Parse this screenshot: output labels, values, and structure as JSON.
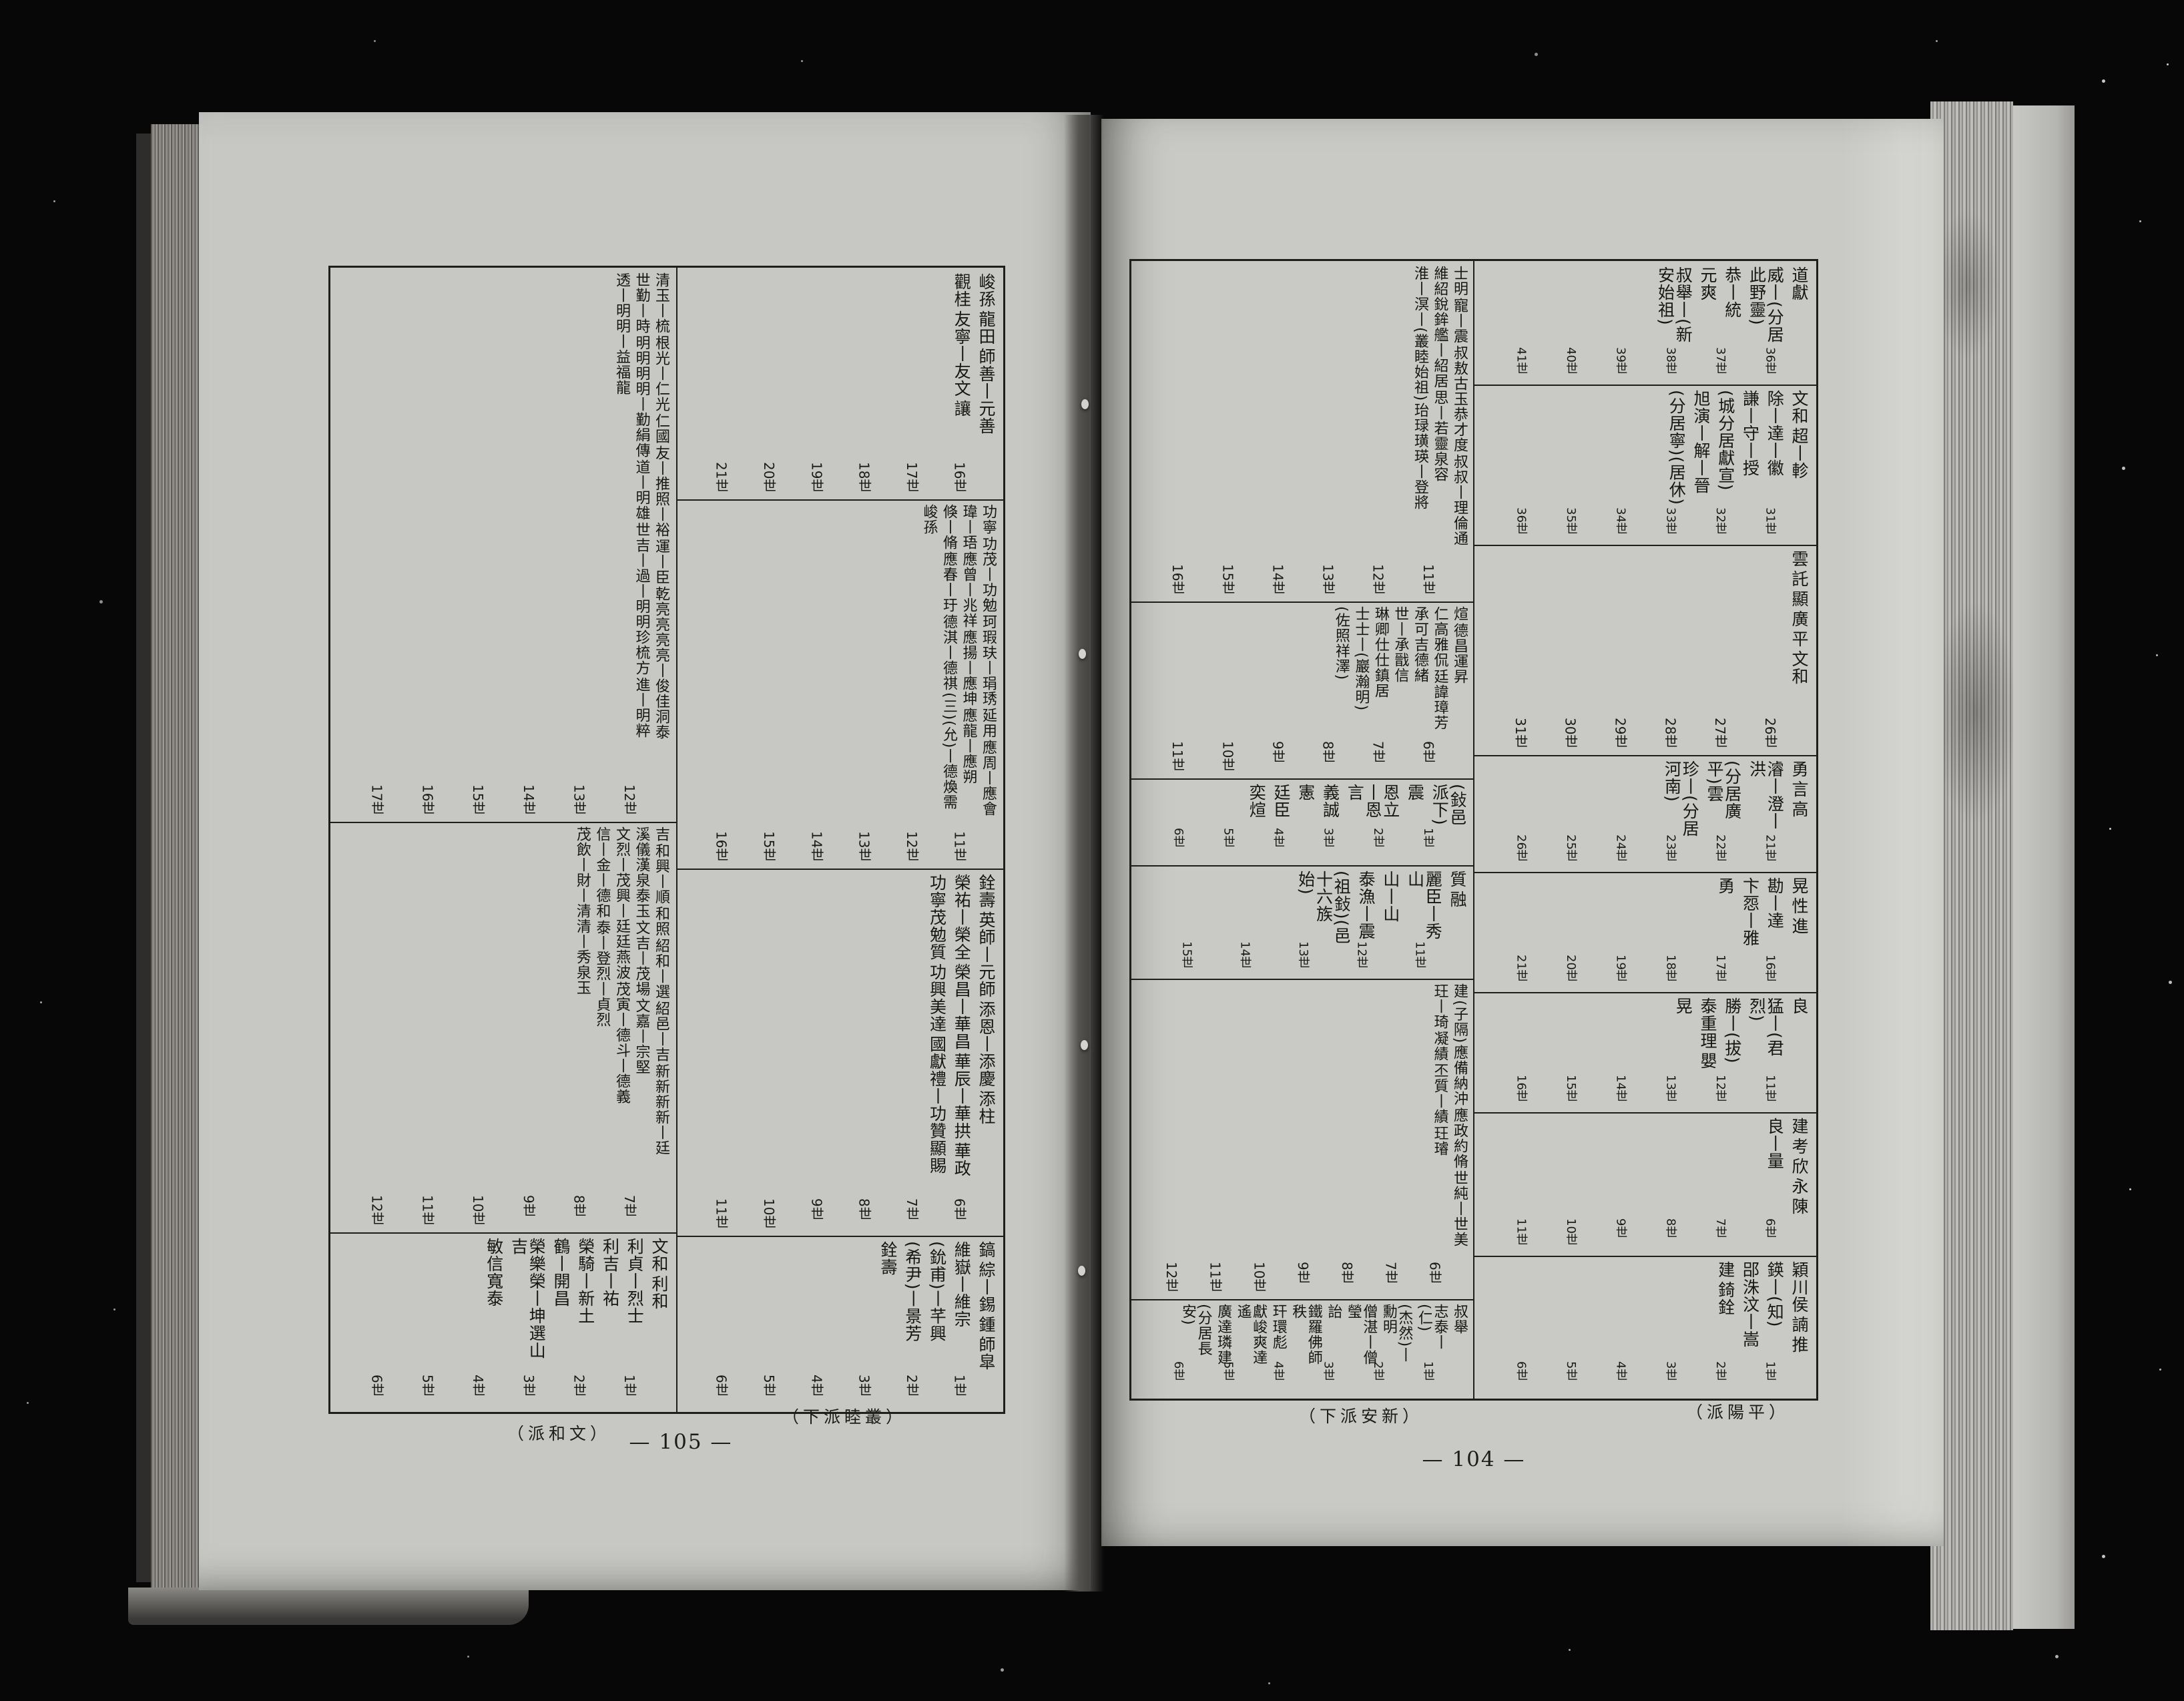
{
  "book": {
    "pages": {
      "left": {
        "page_number": "— 105 —",
        "margin_note_left": "（派和文）",
        "margin_note_right": "（下派睦叢）",
        "sections": {
          "a": {
            "generations": [
              "16世",
              "17世",
              "18世",
              "19世",
              "20世",
              "21世"
            ],
            "names": [
              "峻孫",
              "龍田",
              "師善丨元善",
              "觀桂",
              "友寧丨友文",
              "讓"
            ]
          },
          "b": {
            "generations": [
              "12世",
              "13世",
              "14世",
              "15世",
              "16世",
              "17世"
            ],
            "names": [
              "清玉丨梳",
              "根光丨仁光",
              "仁國",
              "友丨推照丨裕",
              "運丨臣",
              "乾亮亮亮亮丨俊佳洞泰",
              "世勤丨時",
              "明明明明丨勤絹傳",
              "道丨明雄",
              "世吉丨過丨明明珍梳方",
              "進丨明粹",
              "透丨明明丨益福龍"
            ]
          },
          "c": {
            "generations": [
              "11世",
              "12世",
              "13世",
              "14世",
              "15世",
              "16世"
            ],
            "names": [
              "功寧",
              "功茂丨功勉",
              "珂瑕玞丨琄琇",
              "延用",
              "應周丨應會",
              "瑋丨珸",
              "應曾丨兆祥",
              "應揚丨應坤",
              "應龍丨應朔",
              "倏丨脩",
              "應春丨玗",
              "德淇丨德祺",
              "(三)(允)丨德煥需",
              "峻孫"
            ]
          },
          "d": {
            "generations": [
              "6世",
              "7世",
              "8世",
              "9世",
              "10世",
              "11世"
            ],
            "names": [
              "銓壽",
              "英師丨元師",
              "添恩丨添慶",
              "添柱",
              "榮祐丨榮全",
              "榮昌丨華昌",
              "華辰丨華拱",
              "華政",
              "功寧茂勉質",
              "功興美達",
              "國獻禮丨功贊顯賜"
            ]
          },
          "e": {
            "generations": [
              "1世",
              "2世",
              "3世",
              "4世",
              "5世",
              "6世"
            ],
            "names": [
              "鎬",
              "綜丨錫",
              "鍾",
              "師皐",
              "維嶽丨維宗",
              "(鈗甫)丨芊興",
              "(希尹)丨景芳",
              "銓壽"
            ]
          },
          "f": {
            "generations": [
              "7世",
              "8世",
              "9世",
              "10世",
              "11世",
              "12世"
            ],
            "names": [
              "吉",
              "和興丨順",
              "和照",
              "紹和丨選",
              "紹邑丨吉",
              "新新新新丨廷",
              "溪儀漢泉泰玉",
              "文吉丨茂場",
              "文嘉丨宗堅",
              "文烈丨茂興丨廷廷燕波",
              "茂寅丨德斗丨德義",
              "信丨金丨德和",
              "泰丨登烈丨貞烈",
              "茂飲丨財丨清清丨秀泉玉"
            ]
          },
          "g": {
            "generations": [
              "1世",
              "2世",
              "3世",
              "4世",
              "5世",
              "6世"
            ],
            "names": [
              "文和",
              "利和",
              "利貞丨烈士",
              "利吉丨祐",
              "榮騎丨新土",
              "鶴丨開昌",
              "榮樂榮丨坤選山吉",
              "敏信寬泰"
            ]
          }
        }
      },
      "right": {
        "page_number": "— 104 —",
        "margin_note_left": "（下派安新）",
        "margin_note_right": "（派陽平）",
        "sections": {
          "a": {
            "generations": [
              "36世",
              "37世",
              "38世",
              "39世",
              "40世",
              "41世"
            ],
            "names": [
              "道獻",
              "威丨(分居此野靈)",
              "恭丨統",
              "元爽",
              "叔舉丨(新安始祖)"
            ]
          },
          "b": {
            "generations": [
              "31世",
              "32世",
              "33世",
              "34世",
              "35世",
              "36世"
            ],
            "names": [
              "文和",
              "超丨軫",
              "除丨達丨徽",
              "謙丨守丨授",
              "(城分居獻宣)",
              "旭演丨解丨晉",
              "(分居寧)(居休)"
            ]
          },
          "c": {
            "generations": [
              "26世",
              "27世",
              "28世",
              "29世",
              "30世",
              "31世"
            ],
            "names": [
              "雲",
              "託",
              "顯",
              "廣",
              "平",
              "文和"
            ]
          },
          "d": {
            "generations": [
              "21世",
              "22世",
              "23世",
              "24世",
              "25世",
              "26世"
            ],
            "names": [
              "勇",
              "言",
              "高",
              "濬丨澄丨洪",
              "(分居廣平)雲",
              "珍丨(分居河南)"
            ]
          },
          "e": {
            "generations": [
              "16世",
              "17世",
              "18世",
              "19世",
              "20世",
              "21世"
            ],
            "names": [
              "晃",
              "性",
              "進",
              "勘丨達",
              "卞㤪丨雅",
              "勇"
            ]
          },
          "f": {
            "generations": [
              "11世",
              "12世",
              "13世",
              "14世",
              "15世",
              "16世"
            ],
            "names": [
              "良",
              "猛丨(君烈)",
              "勝丨(拔)",
              "泰重理",
              "嬰",
              "晃"
            ]
          },
          "g": {
            "generations": [
              "6世",
              "7世",
              "8世",
              "9世",
              "10世",
              "11世"
            ],
            "names": [
              "建",
              "考",
              "欣",
              "永",
              "陳",
              "良丨量"
            ]
          },
          "h": {
            "generations": [
              "1世",
              "2世",
              "3世",
              "4世",
              "5世",
              "6世"
            ],
            "names": [
              "穎川侯",
              "諵",
              "推",
              "鍈丨(知)",
              "郘洙汶丨嵩",
              "建",
              "錡銓"
            ]
          },
          "i": {
            "generations": [
              "11世",
              "12世",
              "13世",
              "14世",
              "15世",
              "16世"
            ],
            "names": [
              "士明",
              "寵丨震",
              "叔敖古玉恭才度",
              "叔叔丨理倫通",
              "維紹銳鉾艦丨紹居",
              "思丨若靈泉容",
              "淮丨溟丨(叢睦始祖)",
              "珆琭璜瑛丨登將"
            ]
          },
          "j": {
            "generations": [
              "6世",
              "7世",
              "8世",
              "9世",
              "10世",
              "11世"
            ],
            "names": [
              "煊",
              "德昌運昇",
              "仁高雅侃",
              "廷諱璋芳",
              "承可吉德緒",
              "世丨承戩信",
              "琳卿仕仕鎮居",
              "士士丨(巖瀚明)",
              "(佐照祥澤)"
            ]
          },
          "k": {
            "generations": [
              "1世",
              "2世",
              "3世",
              "4世",
              "5世",
              "6世"
            ],
            "names": [
              "(鈙邑派下)",
              "震",
              "恩立丨恩言",
              "義誠",
              "憲",
              "廷臣",
              "奕煊"
            ]
          },
          "l": {
            "generations": [
              "11世",
              "12世",
              "13世",
              "14世",
              "15世"
            ],
            "names": [
              "質",
              "融",
              "麗臣丨秀山",
              "山丨山",
              "泰漁丨震",
              "(祖鈙)(邑十六族始)"
            ]
          },
          "m": {
            "generations": [
              "6世",
              "7世",
              "8世",
              "9世",
              "10世",
              "11世",
              "12世"
            ],
            "names": [
              "建",
              "(子隔)",
              "應備納沖",
              "應政約脩",
              "世純丨世美",
              "玨丨琦",
              "凝績",
              "丕質丨績",
              "玨璿"
            ]
          },
          "n": {
            "generations": [
              "1世",
              "2世",
              "3世",
              "4世",
              "5世",
              "6世"
            ],
            "names": [
              "叔舉",
              "志泰丨(仁)",
              "(杰然)丨勳明",
              "僧湛丨僧瑩",
              "詒",
              "鐵羅佛師秩",
              "玕環彪",
              "獻峻爽達遙",
              "廣達璘建",
              "(分居長安)"
            ]
          }
        }
      }
    }
  }
}
